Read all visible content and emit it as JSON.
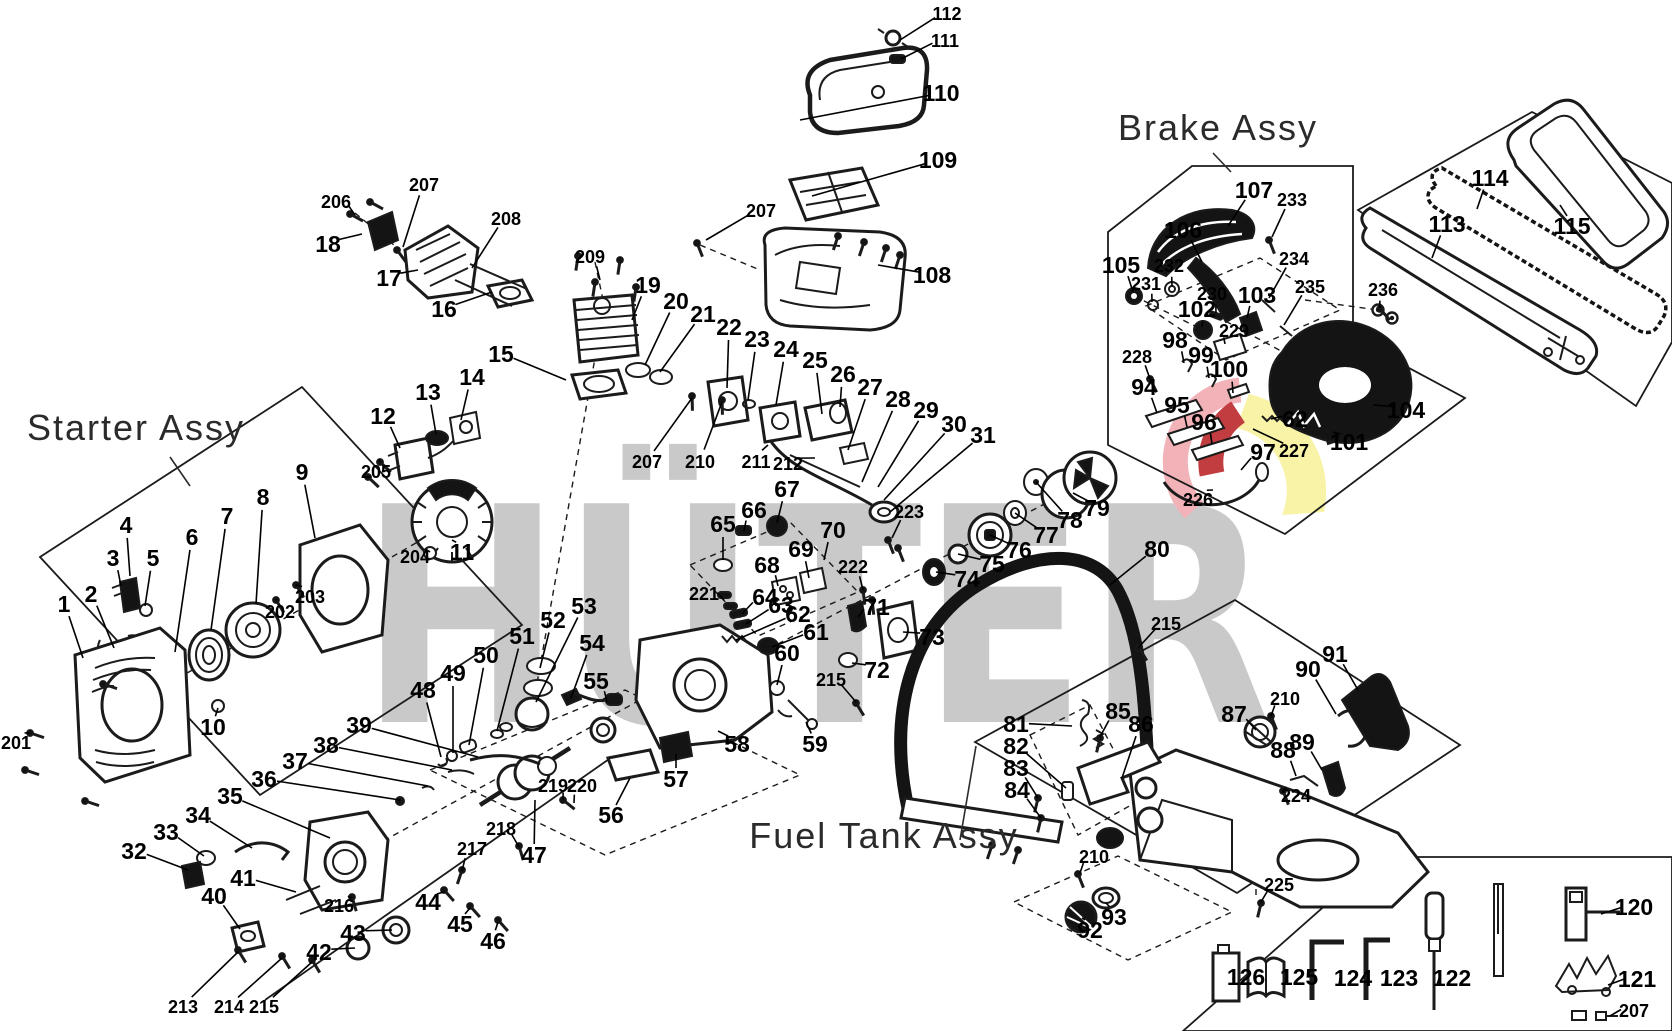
{
  "diagram": {
    "watermark": "HÜTER",
    "colors": {
      "line": "#1b1b1b",
      "watermark_gray": "#c9c9c9",
      "logo_pink": "#f2b3b8",
      "logo_red": "#c23d3f",
      "logo_yellow": "#f8f3a6"
    },
    "assemblies": [
      {
        "label": "Starter Assy",
        "x": 136,
        "y": 440,
        "lx1": 170,
        "ly1": 457,
        "lx2": 190,
        "ly2": 486
      },
      {
        "label": "Brake Assy",
        "x": 1218,
        "y": 140,
        "lx1": 1213,
        "ly1": 153,
        "lx2": 1231,
        "ly2": 172
      },
      {
        "label": "Fuel Tank Assy",
        "x": 884,
        "y": 848,
        "lx1": 960,
        "ly1": 840,
        "lx2": 976,
        "ly2": 746
      }
    ],
    "legend_item_numbers": [
      "120",
      "121",
      "122",
      "123",
      "124",
      "125",
      "126",
      "207"
    ],
    "callouts": [
      [
        "112",
        947,
        20,
        900,
        40,
        1
      ],
      [
        "111",
        945,
        47,
        901,
        59,
        1
      ],
      [
        "110",
        941,
        101,
        800,
        120,
        0
      ],
      [
        "109",
        938,
        168,
        812,
        196,
        0
      ],
      [
        "108",
        932,
        283,
        878,
        265,
        0
      ],
      [
        "207",
        761,
        217,
        706,
        240,
        1
      ],
      [
        "206",
        336,
        208,
        355,
        215,
        1
      ],
      [
        "207",
        424,
        191,
        403,
        247,
        1
      ],
      [
        "18",
        328,
        252,
        362,
        234,
        0
      ],
      [
        "17",
        389,
        286,
        418,
        270,
        0
      ],
      [
        "208",
        506,
        225,
        472,
        268,
        1
      ],
      [
        "16",
        444,
        317,
        492,
        292,
        0
      ],
      [
        "209",
        590,
        263,
        600,
        280,
        1
      ],
      [
        "19",
        648,
        293,
        632,
        320,
        0
      ],
      [
        "15",
        501,
        362,
        566,
        380,
        0
      ],
      [
        "20",
        676,
        309,
        645,
        365,
        0
      ],
      [
        "21",
        703,
        322,
        660,
        372,
        0
      ],
      [
        "22",
        729,
        335,
        727,
        388,
        0
      ],
      [
        "23",
        757,
        347,
        748,
        400,
        0
      ],
      [
        "24",
        786,
        357,
        776,
        405,
        0
      ],
      [
        "25",
        815,
        368,
        822,
        414,
        0
      ],
      [
        "26",
        843,
        382,
        840,
        407,
        0
      ],
      [
        "27",
        870,
        395,
        848,
        450,
        0
      ],
      [
        "28",
        898,
        407,
        862,
        482,
        0
      ],
      [
        "29",
        926,
        418,
        878,
        487,
        0
      ],
      [
        "30",
        954,
        432,
        884,
        500,
        0
      ],
      [
        "31",
        983,
        443,
        890,
        512,
        0
      ],
      [
        "14",
        472,
        385,
        461,
        420,
        0
      ],
      [
        "13",
        428,
        400,
        436,
        434,
        0
      ],
      [
        "12",
        383,
        424,
        400,
        448,
        0
      ],
      [
        "205",
        376,
        478,
        380,
        462,
        1
      ],
      [
        "204",
        415,
        563,
        430,
        552,
        1
      ],
      [
        "11",
        462,
        560,
        452,
        540,
        0
      ],
      [
        "203",
        310,
        603,
        296,
        585,
        1
      ],
      [
        "202",
        280,
        618,
        276,
        600,
        1
      ],
      [
        "9",
        302,
        480,
        315,
        538,
        0
      ],
      [
        "8",
        263,
        505,
        256,
        604,
        0
      ],
      [
        "7",
        227,
        524,
        211,
        630,
        0
      ],
      [
        "6",
        192,
        545,
        175,
        652,
        0
      ],
      [
        "5",
        153,
        566,
        145,
        606,
        0
      ],
      [
        "4",
        126,
        533,
        130,
        576,
        0
      ],
      [
        "3",
        113,
        566,
        121,
        586,
        0
      ],
      [
        "2",
        91,
        602,
        114,
        648,
        0
      ],
      [
        "1",
        64,
        612,
        83,
        658,
        0
      ],
      [
        "10",
        213,
        735,
        218,
        708,
        0
      ],
      [
        "201",
        16,
        749,
        30,
        733,
        1
      ],
      [
        "207",
        647,
        468,
        692,
        398,
        1
      ],
      [
        "210",
        700,
        468,
        722,
        402,
        1
      ],
      [
        "211",
        756,
        468,
        768,
        445,
        1
      ],
      [
        "212",
        788,
        470,
        815,
        458,
        1
      ],
      [
        "67",
        787,
        497,
        777,
        523,
        0
      ],
      [
        "66",
        754,
        518,
        744,
        531,
        0
      ],
      [
        "65",
        723,
        532,
        723,
        560,
        0
      ],
      [
        "70",
        833,
        538,
        824,
        560,
        0
      ],
      [
        "69",
        801,
        557,
        809,
        578,
        0
      ],
      [
        "68",
        767,
        573,
        778,
        586,
        0
      ],
      [
        "64",
        765,
        605,
        742,
        614,
        0
      ],
      [
        "63",
        781,
        613,
        746,
        624,
        0
      ],
      [
        "62",
        798,
        622,
        736,
        640,
        0
      ],
      [
        "61",
        816,
        640,
        772,
        647,
        0
      ],
      [
        "60",
        787,
        661,
        777,
        685,
        0
      ],
      [
        "221",
        704,
        600,
        724,
        600,
        1
      ],
      [
        "222",
        853,
        573,
        863,
        590,
        1
      ],
      [
        "71",
        877,
        615,
        858,
        617,
        0
      ],
      [
        "72",
        877,
        678,
        852,
        663,
        0
      ],
      [
        "223",
        909,
        518,
        892,
        538,
        1
      ],
      [
        "73",
        932,
        645,
        903,
        632,
        0
      ],
      [
        "74",
        967,
        587,
        936,
        572,
        0
      ],
      [
        "75",
        992,
        572,
        958,
        554,
        0
      ],
      [
        "76",
        1019,
        558,
        990,
        535,
        0
      ],
      [
        "77",
        1046,
        543,
        1015,
        513,
        0
      ],
      [
        "78",
        1070,
        528,
        1036,
        482,
        0
      ],
      [
        "79",
        1097,
        516,
        1073,
        493,
        0
      ],
      [
        "80",
        1157,
        557,
        1110,
        585,
        0
      ],
      [
        "215",
        1166,
        630,
        1139,
        647,
        1
      ],
      [
        "215",
        831,
        686,
        856,
        702,
        1
      ],
      [
        "56",
        611,
        823,
        630,
        778,
        0
      ],
      [
        "57",
        676,
        787,
        676,
        754,
        0
      ],
      [
        "58",
        737,
        752,
        718,
        731,
        0
      ],
      [
        "59",
        815,
        752,
        806,
        722,
        0
      ],
      [
        "219",
        553,
        792,
        563,
        800,
        1
      ],
      [
        "220",
        582,
        792,
        574,
        803,
        1
      ],
      [
        "53",
        584,
        614,
        536,
        702,
        0
      ],
      [
        "52",
        553,
        628,
        540,
        668,
        0
      ],
      [
        "51",
        522,
        644,
        497,
        731,
        0
      ],
      [
        "54",
        592,
        651,
        571,
        698,
        0
      ],
      [
        "55",
        596,
        689,
        607,
        702,
        0
      ],
      [
        "50",
        486,
        663,
        469,
        745,
        0
      ],
      [
        "49",
        453,
        681,
        453,
        753,
        0
      ],
      [
        "48",
        423,
        698,
        441,
        757,
        0
      ],
      [
        "39",
        359,
        733,
        478,
        757,
        0
      ],
      [
        "38",
        326,
        753,
        452,
        770,
        0
      ],
      [
        "37",
        295,
        769,
        428,
        786,
        0
      ],
      [
        "36",
        264,
        787,
        400,
        800,
        0
      ],
      [
        "35",
        230,
        804,
        330,
        838,
        0
      ],
      [
        "34",
        198,
        823,
        252,
        848,
        0
      ],
      [
        "33",
        166,
        840,
        204,
        856,
        0
      ],
      [
        "32",
        134,
        859,
        188,
        870,
        0
      ],
      [
        "40",
        214,
        904,
        240,
        929,
        0
      ],
      [
        "41",
        243,
        886,
        296,
        892,
        0
      ],
      [
        "216",
        339,
        912,
        352,
        898,
        1
      ],
      [
        "217",
        472,
        855,
        462,
        871,
        1
      ],
      [
        "218",
        501,
        835,
        519,
        847,
        1
      ],
      [
        "47",
        534,
        863,
        535,
        800,
        0
      ],
      [
        "44",
        428,
        910,
        444,
        892,
        0
      ],
      [
        "45",
        460,
        932,
        470,
        908,
        0
      ],
      [
        "46",
        493,
        949,
        498,
        922,
        0
      ],
      [
        "43",
        353,
        941,
        392,
        930,
        0
      ],
      [
        "42",
        319,
        960,
        355,
        948,
        0
      ],
      [
        "213",
        183,
        1013,
        238,
        952,
        1
      ],
      [
        "214",
        229,
        1013,
        282,
        958,
        1
      ],
      [
        "215",
        264,
        1013,
        312,
        962,
        1
      ],
      [
        "81",
        1016,
        732,
        1072,
        726,
        0
      ],
      [
        "82",
        1016,
        754,
        1066,
        788,
        0
      ],
      [
        "83",
        1016,
        776,
        1038,
        798,
        0
      ],
      [
        "84",
        1017,
        798,
        1041,
        818,
        0
      ],
      [
        "85",
        1118,
        719,
        1100,
        737,
        0
      ],
      [
        "86",
        1141,
        732,
        1122,
        778,
        0
      ],
      [
        "87",
        1234,
        722,
        1256,
        730,
        0
      ],
      [
        "88",
        1283,
        758,
        1296,
        776,
        0
      ],
      [
        "89",
        1302,
        750,
        1322,
        770,
        0
      ],
      [
        "90",
        1308,
        677,
        1336,
        714,
        0
      ],
      [
        "91",
        1335,
        662,
        1358,
        690,
        0
      ],
      [
        "224",
        1296,
        802,
        1283,
        791,
        1
      ],
      [
        "225",
        1279,
        891,
        1261,
        902,
        1
      ],
      [
        "210",
        1285,
        705,
        1271,
        716,
        1
      ],
      [
        "210",
        1094,
        863,
        1080,
        873,
        1
      ],
      [
        "92",
        1090,
        938,
        1082,
        918,
        0
      ],
      [
        "93",
        1114,
        925,
        1106,
        903,
        0
      ],
      [
        "107",
        1254,
        198,
        1228,
        226,
        0
      ],
      [
        "233",
        1292,
        206,
        1272,
        237,
        1
      ],
      [
        "106",
        1183,
        238,
        1202,
        262,
        0
      ],
      [
        "105",
        1121,
        273,
        1133,
        292,
        0
      ],
      [
        "232",
        1169,
        272,
        1172,
        286,
        1
      ],
      [
        "231",
        1146,
        290,
        1152,
        302,
        1
      ],
      [
        "230",
        1212,
        300,
        1216,
        313,
        1
      ],
      [
        "102",
        1197,
        317,
        1202,
        327,
        0
      ],
      [
        "229",
        1234,
        337,
        1225,
        344,
        1
      ],
      [
        "103",
        1257,
        303,
        1247,
        318,
        0
      ],
      [
        "234",
        1294,
        265,
        1269,
        298,
        1
      ],
      [
        "235",
        1310,
        293,
        1284,
        325,
        1
      ],
      [
        "98",
        1175,
        348,
        1184,
        363,
        0
      ],
      [
        "99",
        1201,
        363,
        1209,
        378,
        0
      ],
      [
        "100",
        1229,
        377,
        1233,
        393,
        0
      ],
      [
        "228",
        1137,
        363,
        1150,
        379,
        1
      ],
      [
        "94",
        1144,
        395,
        1157,
        413,
        0
      ],
      [
        "95",
        1177,
        413,
        1187,
        427,
        0
      ],
      [
        "96",
        1204,
        430,
        1212,
        444,
        0
      ],
      [
        "97",
        1263,
        460,
        1241,
        470,
        0
      ],
      [
        "227",
        1294,
        457,
        1253,
        429,
        1
      ],
      [
        "62",
        1295,
        427,
        1271,
        419,
        0
      ],
      [
        "101",
        1349,
        450,
        1333,
        432,
        0
      ],
      [
        "104",
        1406,
        418,
        1373,
        405,
        0
      ],
      [
        "226",
        1198,
        506,
        1213,
        490,
        1
      ],
      [
        "236",
        1383,
        296,
        1380,
        308,
        1
      ],
      [
        "113",
        1447,
        232,
        1432,
        258,
        0
      ],
      [
        "114",
        1490,
        186,
        1477,
        209,
        0
      ],
      [
        "115",
        1572,
        234,
        1560,
        205,
        0
      ],
      [
        "120",
        1634,
        915,
        1601,
        914,
        0
      ],
      [
        "121",
        1637,
        987,
        1608,
        985,
        0
      ],
      [
        "122",
        1452,
        986,
        1437,
        985,
        0
      ],
      [
        "123",
        1399,
        986,
        1385,
        985,
        0
      ],
      [
        "124",
        1353,
        986,
        1339,
        985,
        0
      ],
      [
        "125",
        1299,
        985,
        1286,
        985,
        0
      ],
      [
        "126",
        1246,
        985,
        1234,
        985,
        0
      ],
      [
        "207",
        1634,
        1017,
        1610,
        1016,
        1
      ]
    ]
  }
}
